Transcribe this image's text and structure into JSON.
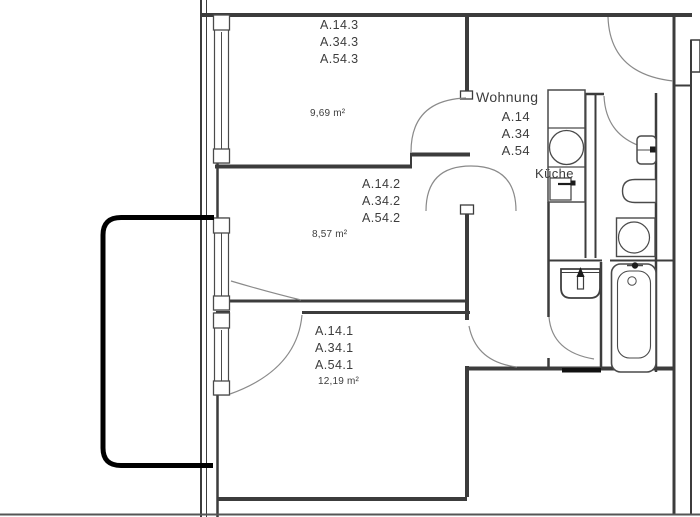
{
  "plan": {
    "apartment": {
      "title": "Wohnung",
      "units": [
        "A.14",
        "A.34",
        "A.54"
      ]
    },
    "rooms": [
      {
        "id": "room-3",
        "labels": [
          "A.14.3",
          "A.34.3",
          "A.54.3"
        ],
        "area": "9,69 m²"
      },
      {
        "id": "room-2",
        "labels": [
          "A.14.2",
          "A.34.2",
          "A.54.2"
        ],
        "area": "8,57 m²"
      },
      {
        "id": "room-1",
        "labels": [
          "A.14.1",
          "A.34.1",
          "A.54.1"
        ],
        "area": "12,19 m²"
      }
    ],
    "kitchen": {
      "label": "Küche"
    },
    "fixtures": [
      "kitchen-sink",
      "stove",
      "washbasin",
      "hand-basin",
      "toilet",
      "washing-machine",
      "bathtub",
      "balcony"
    ],
    "colors": {
      "walls": "#3c3c3c",
      "thin_lines": "#5a5a5a",
      "door_arcs": "#8a8a8a",
      "balcony": "#000000",
      "fixture_dark": "#1c1c1c",
      "text": "#3d3d3d",
      "background": "#ffffff"
    }
  }
}
